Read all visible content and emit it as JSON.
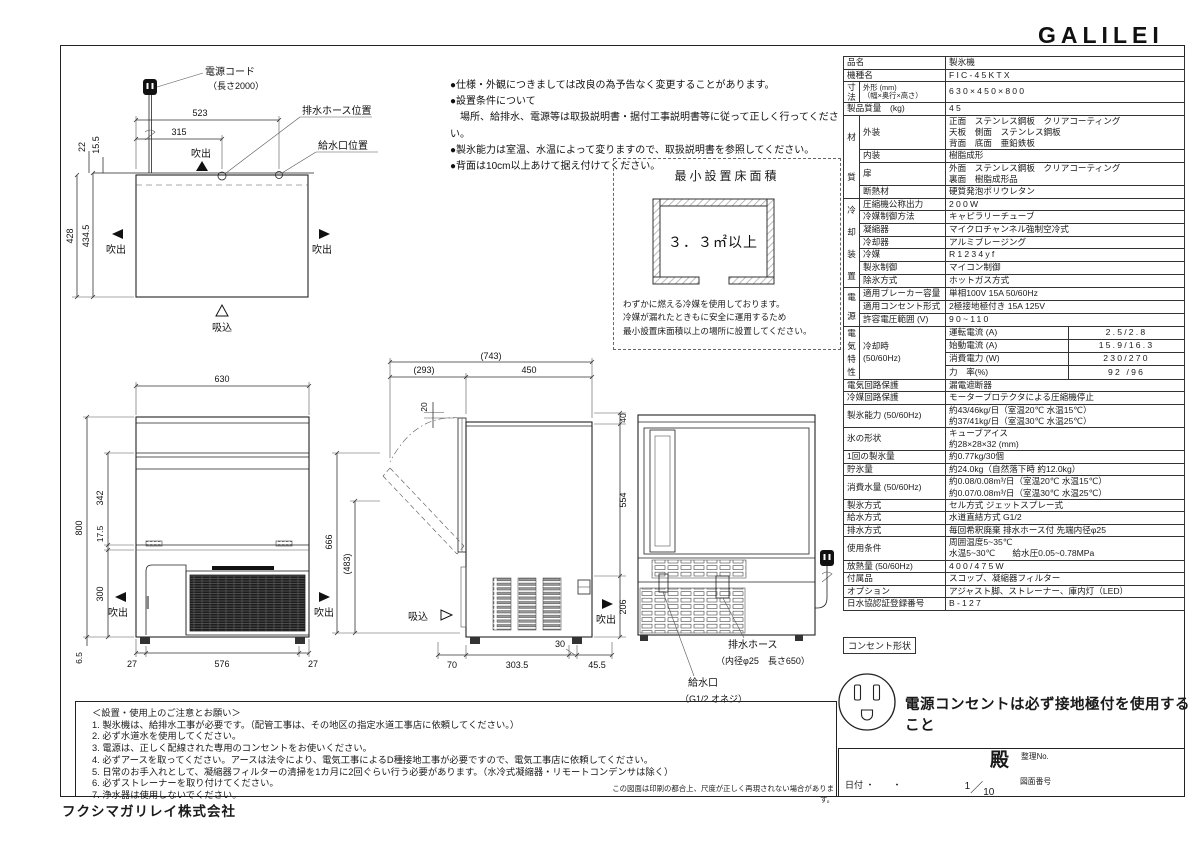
{
  "header": {
    "logo": "GALILEI"
  },
  "notes_top": [
    "●仕様・外観につきましては改良の為予告なく変更することがあります。",
    "●設置条件について",
    "　場所、給排水、電源等は取扱説明書・据付工事説明書等に従って正しく行ってください。",
    "●製氷能力は室温、水温によって変りますので、取扱説明書を参照してください。",
    "●背面は10cm以上あけて据え付けてください。"
  ],
  "min_area": {
    "title": "最小設置床面積",
    "value": "３．３㎡以上",
    "caption": [
      "わずかに燃える冷媒を使用しております。",
      "冷媒が漏れたときもに安全に運用するため",
      "最小設置床面積以上の場所に設置してください。"
    ]
  },
  "spec_table": {
    "rows": [
      [
        {
          "t": "品名",
          "cs": 2,
          "cls": "l"
        },
        {
          "t": "製氷機",
          "cs": 2,
          "cls": "v"
        }
      ],
      [
        {
          "t": "機種名",
          "cs": 2,
          "cls": "l"
        },
        {
          "t": "FIC-45KTX",
          "cs": 2,
          "cls": "v sp"
        }
      ],
      [
        {
          "t": [
            "寸",
            "法"
          ],
          "cls": "g lh10"
        },
        {
          "t": [
            "外形 (mm)",
            "（幅×奥行×高さ）"
          ],
          "cls": "l sm"
        },
        {
          "t": "630×450×800",
          "cs": 2,
          "cls": "v sp"
        }
      ],
      [
        {
          "t": "製品質量　(kg)",
          "cs": 2,
          "cls": "l"
        },
        {
          "t": "45",
          "cs": 2,
          "cls": "v sp"
        }
      ],
      [
        {
          "t": [
            "材",
            "質"
          ],
          "cls": "g lh44",
          "rs": 4
        },
        {
          "t": "外装",
          "cls": "l"
        },
        {
          "t": [
            "正面　ステンレス鋼板　クリアコーティング",
            "天板　側面　ステンレス鋼板",
            "背面　底面　亜鉛鉄板"
          ],
          "cs": 2,
          "cls": "v mlv"
        }
      ],
      [
        {
          "t": "内装",
          "cls": "l"
        },
        {
          "t": "樹脂成形",
          "cs": 2,
          "cls": "v"
        }
      ],
      [
        {
          "t": "扉",
          "cls": "l"
        },
        {
          "t": [
            "外面　ステンレス鋼板　クリアコーティング",
            "裏面　樹脂成形品"
          ],
          "cs": 2,
          "cls": "v mlv"
        }
      ],
      [
        {
          "t": "断熱材",
          "cls": "l"
        },
        {
          "t": "硬質発泡ポリウレタン",
          "cs": 2,
          "cls": "v"
        }
      ],
      [
        {
          "t": [
            "冷",
            "却",
            "装",
            "置"
          ],
          "cls": "g lh22",
          "rs": 7
        },
        {
          "t": "圧縮機公称出力",
          "cls": "l"
        },
        {
          "t": "200W",
          "cs": 2,
          "cls": "v sp"
        }
      ],
      [
        {
          "t": "冷媒制御方法",
          "cls": "l"
        },
        {
          "t": "キャピラリーチューブ",
          "cs": 2,
          "cls": "v"
        }
      ],
      [
        {
          "t": "凝縮器",
          "cls": "l"
        },
        {
          "t": "マイクロチャンネル強制空冷式",
          "cs": 2,
          "cls": "v"
        }
      ],
      [
        {
          "t": "冷却器",
          "cls": "l"
        },
        {
          "t": "アルミブレージング",
          "cs": 2,
          "cls": "v"
        }
      ],
      [
        {
          "t": "冷媒",
          "cls": "l"
        },
        {
          "t": "R1234yf",
          "cs": 2,
          "cls": "v sp"
        }
      ],
      [
        {
          "t": "製氷制御",
          "cls": "l"
        },
        {
          "t": "マイコン制御",
          "cs": 2,
          "cls": "v"
        }
      ],
      [
        {
          "t": "除氷方式",
          "cls": "l"
        },
        {
          "t": "ホットガス方式",
          "cs": 2,
          "cls": "v"
        }
      ],
      [
        {
          "t": [
            "電",
            "源"
          ],
          "cls": "g lh19",
          "rs": 3
        },
        {
          "t": "適用ブレーカー容量",
          "cls": "l"
        },
        {
          "t": "単相100V 15A 50/60Hz",
          "cs": 2,
          "cls": "v"
        }
      ],
      [
        {
          "t": "適用コンセント形式",
          "cls": "l"
        },
        {
          "t": "2極接地極付き 15A 125V",
          "cs": 2,
          "cls": "v"
        }
      ],
      [
        {
          "t": "許容電圧範囲 (V)",
          "cls": "l"
        },
        {
          "t": "90~110",
          "cs": 2,
          "cls": "v sp"
        }
      ],
      [
        {
          "t": [
            "電",
            "気",
            "特",
            "性"
          ],
          "cls": "g lh13",
          "rs": 4
        },
        {
          "t": [
            "冷却時",
            "(50/60Hz)"
          ],
          "cls": "l",
          "rs": 4
        },
        {
          "t": "運転電流 (A)",
          "cls": "s"
        },
        {
          "t": "2.5/2.8",
          "cls": "v c sp"
        }
      ],
      [
        {
          "t": "始動電流 (A)",
          "cls": "s"
        },
        {
          "t": "15.9/16.3",
          "cls": "v c sp"
        }
      ],
      [
        {
          "t": "消費電力 (W)",
          "cls": "s"
        },
        {
          "t": "230/270",
          "cls": "v c sp"
        }
      ],
      [
        {
          "t": "力　率(%)",
          "cls": "s"
        },
        {
          "t": "92 /96",
          "cls": "v c sp"
        }
      ],
      [
        {
          "t": "電気回路保護",
          "cs": 2,
          "cls": "l"
        },
        {
          "t": "漏電遮断器",
          "cs": 2,
          "cls": "v"
        }
      ],
      [
        {
          "t": "冷媒回路保護",
          "cs": 2,
          "cls": "l"
        },
        {
          "t": "モータープロテクタによる圧縮機停止",
          "cs": 2,
          "cls": "v"
        }
      ],
      [
        {
          "t": "製氷能力 (50/60Hz)",
          "cs": 2,
          "cls": "l"
        },
        {
          "t": [
            "約43/46kg/日（室温20℃ 水温15℃）",
            "約37/41kg/日（室温30℃ 水温25℃）"
          ],
          "cs": 2,
          "cls": "v mlv"
        }
      ],
      [
        {
          "t": "氷の形状",
          "cs": 2,
          "cls": "l"
        },
        {
          "t": [
            "キューブアイス",
            "約28×28×32 (mm)"
          ],
          "cs": 2,
          "cls": "v mlv"
        }
      ],
      [
        {
          "t": "1回の製氷量",
          "cs": 2,
          "cls": "l"
        },
        {
          "t": "約0.77kg/30個",
          "cs": 2,
          "cls": "v"
        }
      ],
      [
        {
          "t": "貯氷量",
          "cs": 2,
          "cls": "l"
        },
        {
          "t": "約24.0kg（自然落下時 約12.0kg）",
          "cs": 2,
          "cls": "v"
        }
      ],
      [
        {
          "t": "消費水量 (50/60Hz)",
          "cs": 2,
          "cls": "l"
        },
        {
          "t": [
            "約0.08/0.08m³/日（室温20℃ 水温15℃）",
            "約0.07/0.08m³/日（室温30℃ 水温25℃）"
          ],
          "cs": 2,
          "cls": "v mlv"
        }
      ],
      [
        {
          "t": "製氷方式",
          "cs": 2,
          "cls": "l"
        },
        {
          "t": "セル方式 ジェットスプレー式",
          "cs": 2,
          "cls": "v"
        }
      ],
      [
        {
          "t": "給水方式",
          "cs": 2,
          "cls": "l"
        },
        {
          "t": "水道直結方式 G1/2",
          "cs": 2,
          "cls": "v"
        }
      ],
      [
        {
          "t": "排水方式",
          "cs": 2,
          "cls": "l"
        },
        {
          "t": "毎回希釈廃棄 排水ホース付 先端内径φ25",
          "cs": 2,
          "cls": "v"
        }
      ],
      [
        {
          "t": "使用条件",
          "cs": 2,
          "cls": "l"
        },
        {
          "t": [
            "周囲温度5~35℃",
            "水温5~30℃　　給水圧0.05~0.78MPa"
          ],
          "cs": 2,
          "cls": "v mlv"
        }
      ],
      [
        {
          "t": "放熱量 (50/60Hz)",
          "cs": 2,
          "cls": "l"
        },
        {
          "t": "400/475W",
          "cs": 2,
          "cls": "v sp"
        }
      ],
      [
        {
          "t": "付属品",
          "cs": 2,
          "cls": "l"
        },
        {
          "t": "スコップ、凝縮器フィルター",
          "cs": 2,
          "cls": "v"
        }
      ],
      [
        {
          "t": "オプション",
          "cs": 2,
          "cls": "l"
        },
        {
          "t": "アジャスト脚、ストレーナー、庫内灯（LED）",
          "cs": 2,
          "cls": "v"
        }
      ],
      [
        {
          "t": "日水協認証登録番号",
          "cs": 2,
          "cls": "l"
        },
        {
          "t": "B-127",
          "cs": 2,
          "cls": "v sp"
        }
      ]
    ]
  },
  "drawings": {
    "plan": {
      "power_cord": "電源コード",
      "power_cord_len": "（長さ2000）",
      "d523": "523",
      "d315": "315",
      "d22": "22",
      "d15_5": "15.5",
      "d428": "428",
      "d434_5": "434.5",
      "drain_pos": "排水ホース位置",
      "supply_pos": "給水口位置",
      "blow": "吹出",
      "suck": "吸込"
    },
    "front": {
      "d630": "630",
      "d800": "800",
      "d342": "342",
      "d17_5": "17.5",
      "d300": "300",
      "d6_5": "6.5",
      "d27": "27",
      "d576": "576",
      "blow": "吹出"
    },
    "side": {
      "d743": "(743)",
      "d293": "(293)",
      "d450": "450",
      "d20": "20",
      "d40": "40",
      "d554": "554",
      "d206": "206",
      "d666": "666",
      "d483": "(483)",
      "d70": "70",
      "d303_5": "303.5",
      "d30": "30",
      "d45_5": "45.5",
      "suck": "吸込",
      "blow": "吹出"
    },
    "rear": {
      "drain": "排水ホース",
      "drain_note": "（内径φ25　長さ650）",
      "supply": "給水口",
      "supply_note": "（G1/2 オネジ）"
    }
  },
  "notes_bottom": {
    "title": "＜設置・使用上のご注意とお願い＞",
    "items": [
      "1. 製氷機は、給排水工事が必要です。（配管工事は、その地区の指定水道工事店に依頼してください。）",
      "2. 必ず水道水を使用してください。",
      "3. 電源は、正しく配線された専用のコンセントをお使いください。",
      "4. 必ずアースを取ってください。アースは法令により、電気工事によるD種接地工事が必要ですので、電気工事店に依頼してください。",
      "5. 日常のお手入れとして、凝縮器フィルターの清掃を1カ月に2回ぐらい行う必要があります。（水冷式凝縮器・リモートコンデンサは除く）",
      "6. 必ずストレーナーを取り付けてください。",
      "7. 浄水器は使用しないでください。"
    ]
  },
  "outlet": {
    "label": "コンセント形状",
    "message": "電源コンセントは必ず接地極付を使用すること"
  },
  "titleblock": {
    "tono": "殿",
    "reg_no_label": "整理No.",
    "date_label": "日付",
    "date_value": "・　　・",
    "scale": {
      "num": "1",
      "sep": "／",
      "den": "10"
    },
    "drawing_no_label": "図面番号",
    "disclaimer": "この図面は印刷の都合上、尺度が正しく再現されない場合があります。"
  },
  "company": {
    "name": "フクシマガリレイ株式会社"
  }
}
